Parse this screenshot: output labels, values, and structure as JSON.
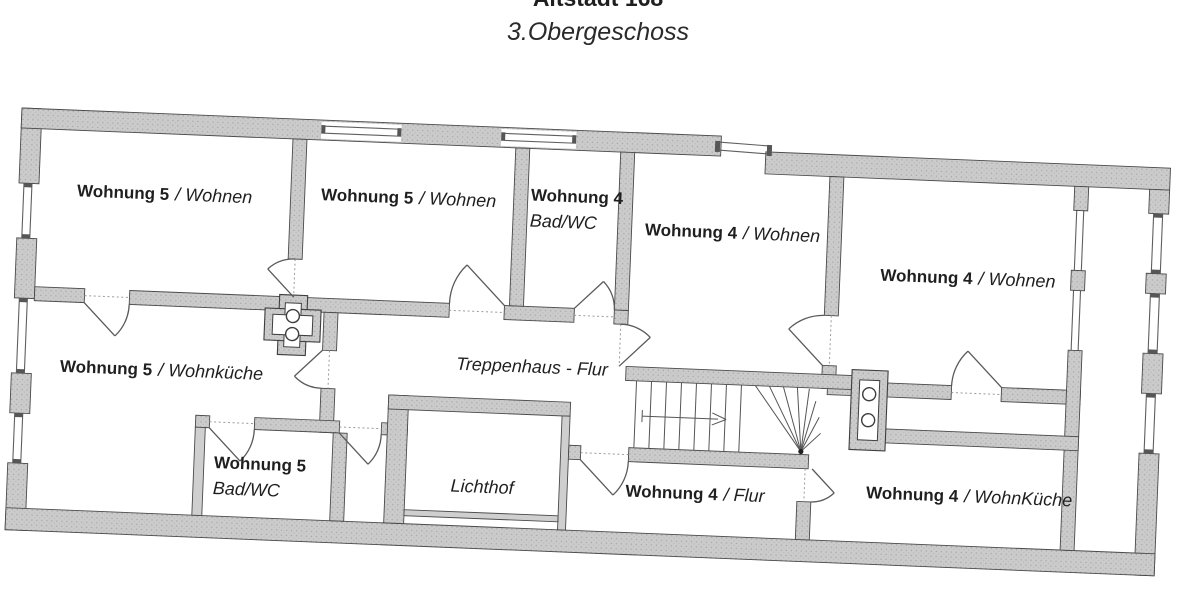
{
  "header": {
    "building": "Altstadt 168",
    "floor": "3.Obergeschoss"
  },
  "rooms": {
    "r1": {
      "apt": "Wohnung 5",
      "type": "/ Wohnen"
    },
    "r2": {
      "apt": "Wohnung 5",
      "type": "/ Wohnen"
    },
    "r3": {
      "apt": "Wohnung 4",
      "type": "Bad/WC"
    },
    "r4": {
      "apt": "Wohnung 4",
      "type": "/ Wohnen"
    },
    "r5": {
      "apt": "Wohnung 4",
      "type": "/ Wohnen"
    },
    "r6": {
      "apt": "Wohnung 5",
      "type": "/ Wohnküche"
    },
    "r7": {
      "apt": "Wohnung 5",
      "type": "Bad/WC"
    },
    "r9": {
      "apt": "Wohnung 4",
      "type": "/ Flur"
    },
    "r10": {
      "apt": "Wohnung 4",
      "type": "/ WohnKüche"
    },
    "stairhall": {
      "label": "Treppenhaus - Flur"
    },
    "lichthof": {
      "label": "Lichthof"
    }
  },
  "colors": {
    "wall_fill": "#cbcbcb",
    "wall_speckle": "#a3a3a3",
    "outline": "#4a4a4a",
    "text": "#1f1f1f",
    "background": "#ffffff"
  }
}
